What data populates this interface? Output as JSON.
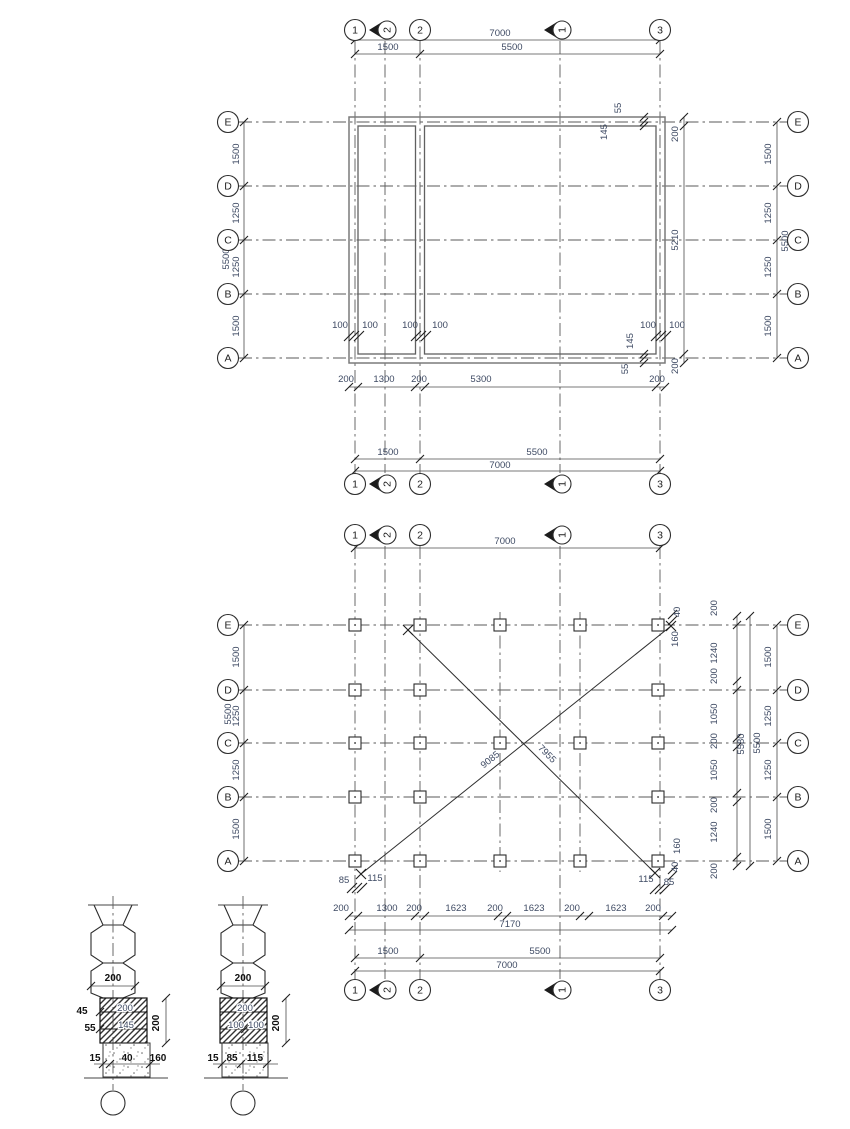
{
  "colors": {
    "dim_text": "#3e4a63",
    "ink": "#111111",
    "wall": "#7a7a7a",
    "line": "#4c4c4c"
  },
  "grid": {
    "cols": [
      "1",
      "2",
      "3"
    ],
    "sections": [
      "2",
      "1"
    ],
    "rows": [
      "E",
      "D",
      "C",
      "B",
      "A"
    ]
  },
  "plan1": {
    "top": {
      "total": "7000",
      "a": "1500",
      "b": "5500"
    },
    "bottom": {
      "a": "1500",
      "b": "5500",
      "total": "7000"
    },
    "left": {
      "chain": [
        "1500",
        "1250",
        "1250",
        "1500"
      ],
      "total": "5500"
    },
    "right": {
      "chain": [
        "1500",
        "1250",
        "1250",
        "1500"
      ],
      "total": "5500",
      "inner": [
        "200",
        "5210",
        "200"
      ]
    },
    "bottom_chain": [
      "200",
      "1300",
      "200",
      "5300",
      "200"
    ],
    "wall": {
      "pair": "100",
      "tr_a": "55",
      "tr_b": "145",
      "br_a": "145",
      "br_b": "55"
    }
  },
  "plan2": {
    "top": {
      "total": "7000"
    },
    "bottom": {
      "a": "1500",
      "b": "5500",
      "total": "7000"
    },
    "left": {
      "chain": [
        "1500",
        "1250",
        "1250",
        "1500"
      ],
      "total": "5500"
    },
    "right": {
      "outer_chain": [
        "1500",
        "1250",
        "1250",
        "1500"
      ],
      "outer_total": "5500",
      "inner_chain": [
        "200",
        "1240",
        "200",
        "1050",
        "200",
        "1050",
        "200",
        "1240",
        "200"
      ],
      "inner_total": "5580"
    },
    "bottom_chain": [
      "200",
      "1300",
      "200",
      "1623",
      "200",
      "1623",
      "200",
      "1623",
      "200"
    ],
    "bottom_chain_total": "7170",
    "diag": {
      "d1": "7955",
      "d2": "9085"
    },
    "corner_bl": {
      "a": "85",
      "b": "115"
    },
    "corner_br": {
      "a": "115",
      "b": "85",
      "c": "40",
      "d": "160"
    },
    "corner_tr": {
      "a": "40",
      "b": "160"
    }
  },
  "details": {
    "d1": {
      "width": "200",
      "height": "200",
      "hatch_a": "200",
      "hatch_b": "145",
      "off_a": "45",
      "off_b": "55",
      "base_a": "15",
      "base_b": "40",
      "base_c": "160"
    },
    "d2": {
      "width": "200",
      "height": "200",
      "hatch_a": "200",
      "hatch_b1": "100",
      "hatch_b2": "100",
      "base_a": "15",
      "base_b": "85",
      "base_c": "115"
    }
  }
}
